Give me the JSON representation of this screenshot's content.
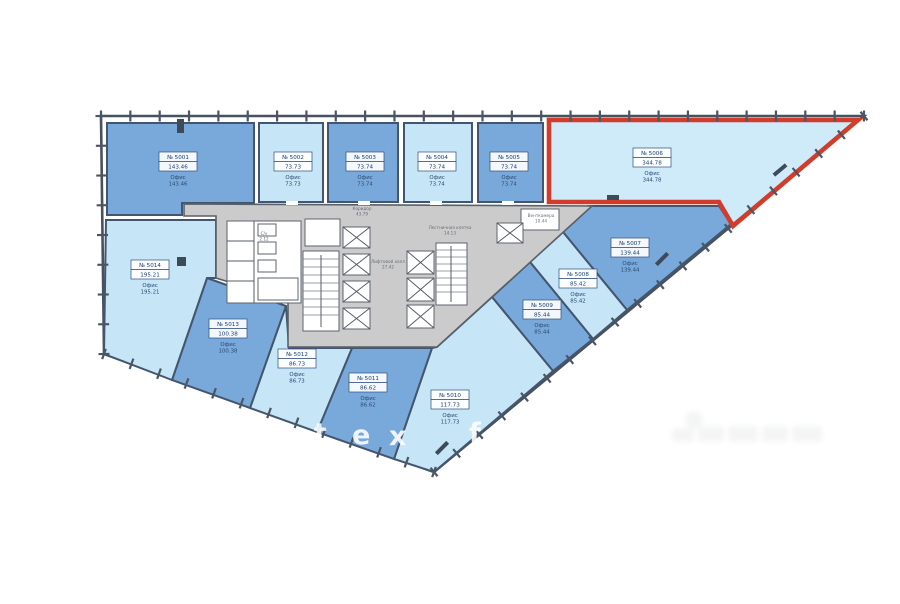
{
  "plan": {
    "colors": {
      "room_dark": "#79a9da",
      "room_light": "#c6e5f6",
      "highlight_fill": "#cfeaf8",
      "highlight_outline": "#d13c2b",
      "core_fill": "#cbcbcb",
      "wall": "#44566e"
    },
    "unit_label_type": "Офис",
    "rooms": [
      {
        "number": "№ 5001",
        "area": "143.46",
        "type": "Офис",
        "shade": "dark",
        "highlighted": false
      },
      {
        "number": "№ 5002",
        "area": "73.73",
        "type": "Офис",
        "shade": "light",
        "highlighted": false
      },
      {
        "number": "№ 5003",
        "area": "73.74",
        "type": "Офис",
        "shade": "dark",
        "highlighted": false
      },
      {
        "number": "№ 5004",
        "area": "73.74",
        "type": "Офис",
        "shade": "light",
        "highlighted": false
      },
      {
        "number": "№ 5005",
        "area": "73.74",
        "type": "Офис",
        "shade": "dark",
        "highlighted": false
      },
      {
        "number": "№ 5006",
        "area": "344.78",
        "type": "Офис",
        "shade": "light",
        "highlighted": true
      },
      {
        "number": "№ 5007",
        "area": "139.44",
        "type": "Офис",
        "shade": "dark",
        "highlighted": false
      },
      {
        "number": "№ 5008",
        "area": "85.42",
        "type": "Офис",
        "shade": "light",
        "highlighted": false
      },
      {
        "number": "№ 5009",
        "area": "85.44",
        "type": "Офис",
        "shade": "dark",
        "highlighted": false
      },
      {
        "number": "№ 5010",
        "area": "117.73",
        "type": "Офис",
        "shade": "light",
        "highlighted": false
      },
      {
        "number": "№ 5011",
        "area": "86.62",
        "type": "Офис",
        "shade": "dark",
        "highlighted": false
      },
      {
        "number": "№ 5012",
        "area": "86.73",
        "type": "Офис",
        "shade": "light",
        "highlighted": false
      },
      {
        "number": "№ 5013",
        "area": "100.38",
        "type": "Офис",
        "shade": "dark",
        "highlighted": false
      },
      {
        "number": "№ 5014",
        "area": "195.21",
        "type": "Офис",
        "shade": "light",
        "highlighted": false
      }
    ],
    "core_labels": [
      {
        "line1": "Коридор",
        "line2": "43.79"
      },
      {
        "line1": "Лифтовой холл",
        "line2": "27.42"
      },
      {
        "line1": "Лестничная клетка",
        "line2": "14.13"
      },
      {
        "line1": "Венткамера",
        "line2": "10.44"
      },
      {
        "line1": "С/у",
        "line2": "2.12"
      }
    ],
    "watermark": {
      "letters": [
        {
          "char": "t",
          "x": 314,
          "y": 442
        },
        {
          "char": "e",
          "x": 352,
          "y": 444
        },
        {
          "char": "x",
          "x": 389,
          "y": 445
        },
        {
          "char": "f",
          "x": 469,
          "y": 442
        }
      ]
    }
  }
}
